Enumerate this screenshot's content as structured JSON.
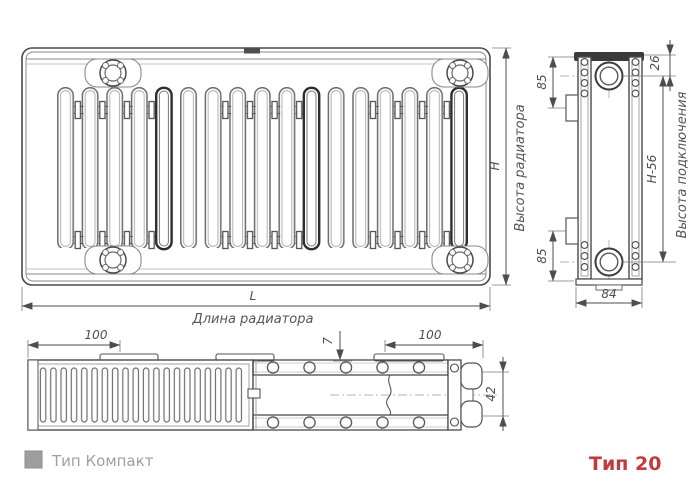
{
  "drawing": {
    "front": {
      "length_dim": "L",
      "length_caption": "Длина радиатора",
      "height_dim": "H",
      "height_caption": "Высота радиатора"
    },
    "side": {
      "top_offset": "85",
      "top_connection": "26",
      "connection_span": "H-56",
      "bottom_offset": "85",
      "depth": "84",
      "connection_caption": "Высота подключения"
    },
    "plan": {
      "left_offset": "100",
      "sheet_gap": "7",
      "right_offset": "100",
      "panel_spacing": "42"
    }
  },
  "legend": {
    "swatch_color": "#9e9e9e",
    "label": "Тип Компакт"
  },
  "type_label": {
    "text": "Тип 20",
    "color": "#c23b3b"
  }
}
